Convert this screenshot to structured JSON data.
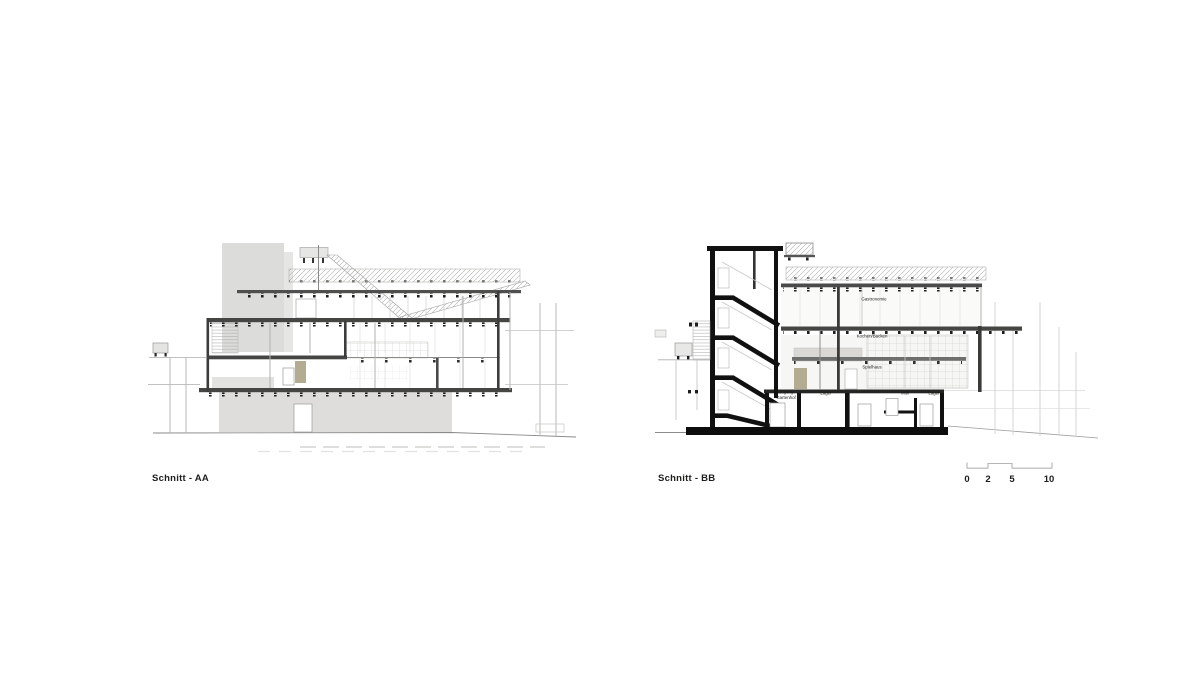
{
  "titles": {
    "aa": "Schnitt - AA",
    "bb": "Schnitt - BB"
  },
  "room_labels": {
    "gastronomie": "Gastronomie",
    "kochen_backen": "Kochen/Backen",
    "spielhaus": "Spielhaus",
    "zugang_line1": "Zugang",
    "zugang_line2": "Gartenhof",
    "lager_1": "Lager",
    "muell": "Müll",
    "lager_2": "Lager"
  },
  "scale_bar": {
    "ticks": [
      "0",
      "2",
      "5",
      "10"
    ]
  },
  "colors": {
    "background": "#ffffff",
    "ink": "#1d1d1b",
    "cut_black": "#111111",
    "slab_dark": "#454543",
    "fill_light_gray": "#dedddb",
    "door_tan": "#b3ab92",
    "line_light": "#b5b5b3"
  }
}
